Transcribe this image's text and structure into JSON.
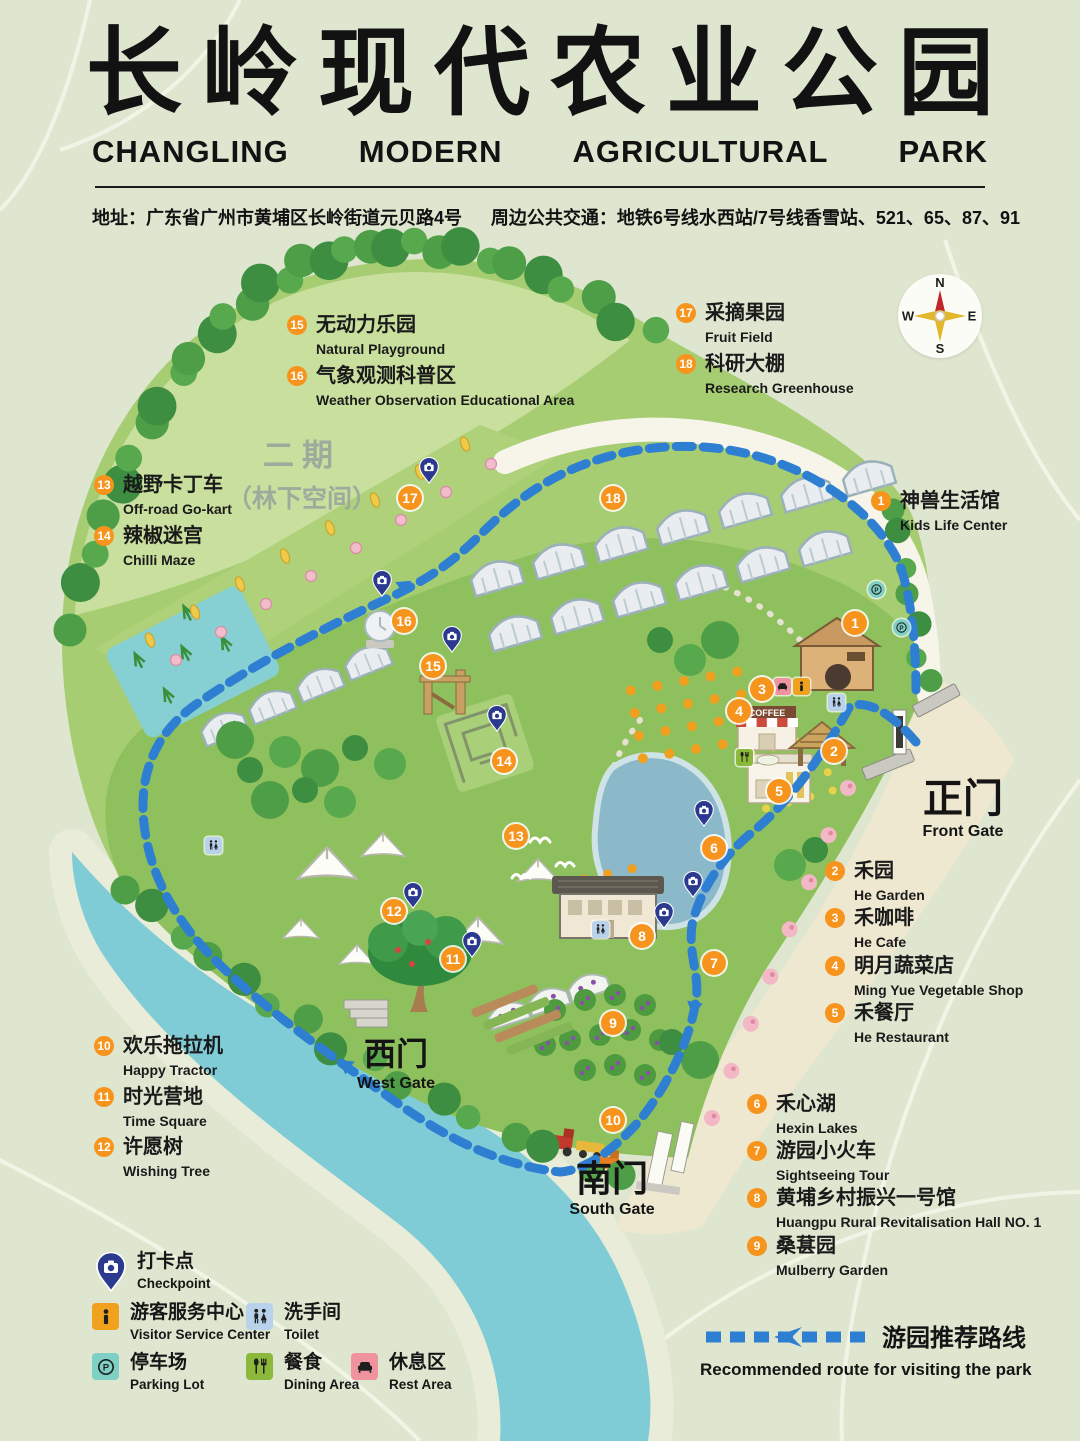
{
  "header": {
    "title_zh": "长岭现代农业公园",
    "title_en_words": [
      "CHANGLING",
      "MODERN",
      "AGRICULTURAL",
      "PARK"
    ],
    "address": "地址：广东省广州市黄埔区长岭街道元贝路4号",
    "transit": "周边公共交通：地铁6号线水西站/7号线香雪站、521、65、87、91"
  },
  "compass": {
    "n": "N",
    "e": "E",
    "s": "S",
    "w": "W"
  },
  "phase2": {
    "line1": "二期",
    "line2": "（林下空间）"
  },
  "gates": [
    {
      "id": "front-gate",
      "zh": "正门",
      "en": "Front Gate",
      "x": 963,
      "y": 778,
      "zh_size": 40
    },
    {
      "id": "west-gate",
      "zh": "西门",
      "en": "West Gate",
      "x": 396,
      "y": 1038,
      "zh_size": 32
    },
    {
      "id": "south-gate",
      "zh": "南门",
      "en": "South Gate",
      "x": 612,
      "y": 1160,
      "zh_size": 36
    }
  ],
  "pois": [
    {
      "num": 1,
      "zh": "神兽生活馆",
      "en": "Kids Life Center",
      "label": {
        "x": 881,
        "y": 501
      },
      "marker": {
        "x": 855,
        "y": 623
      }
    },
    {
      "num": 2,
      "zh": "禾园",
      "en": "He Garden",
      "label": {
        "x": 835,
        "y": 871
      },
      "marker": {
        "x": 834,
        "y": 751
      }
    },
    {
      "num": 3,
      "zh": "禾咖啡",
      "en": "He Cafe",
      "label": {
        "x": 835,
        "y": 918
      },
      "marker": {
        "x": 762,
        "y": 689
      }
    },
    {
      "num": 4,
      "zh": "明月蔬菜店",
      "en": "Ming Yue Vegetable Shop",
      "label": {
        "x": 835,
        "y": 966
      },
      "marker": {
        "x": 739,
        "y": 711
      }
    },
    {
      "num": 5,
      "zh": "禾餐厅",
      "en": "He Restaurant",
      "label": {
        "x": 835,
        "y": 1013
      },
      "marker": {
        "x": 779,
        "y": 791
      }
    },
    {
      "num": 6,
      "zh": "禾心湖",
      "en": "Hexin Lakes",
      "label": {
        "x": 757,
        "y": 1104
      },
      "marker": {
        "x": 714,
        "y": 848
      }
    },
    {
      "num": 7,
      "zh": "游园小火车",
      "en": "Sightseeing Tour",
      "label": {
        "x": 757,
        "y": 1151
      },
      "marker": {
        "x": 714,
        "y": 963
      }
    },
    {
      "num": 8,
      "zh": "黄埔乡村振兴一号馆",
      "en": "Huangpu Rural Revitalisation Hall NO. 1",
      "label": {
        "x": 757,
        "y": 1198
      },
      "marker": {
        "x": 642,
        "y": 936
      }
    },
    {
      "num": 9,
      "zh": "桑葚园",
      "en": "Mulberry Garden",
      "label": {
        "x": 757,
        "y": 1246
      },
      "marker": {
        "x": 613,
        "y": 1023
      }
    },
    {
      "num": 10,
      "zh": "欢乐拖拉机",
      "en": "Happy Tractor",
      "label": {
        "x": 104,
        "y": 1046
      },
      "marker": {
        "x": 613,
        "y": 1120
      }
    },
    {
      "num": 11,
      "zh": "时光营地",
      "en": "Time Square",
      "label": {
        "x": 104,
        "y": 1097
      },
      "marker": {
        "x": 453,
        "y": 959
      }
    },
    {
      "num": 12,
      "zh": "许愿树",
      "en": "Wishing Tree",
      "label": {
        "x": 104,
        "y": 1147
      },
      "marker": {
        "x": 394,
        "y": 911
      }
    },
    {
      "num": 13,
      "zh": "越野卡丁车",
      "en": "Off-road Go-kart",
      "label": {
        "x": 104,
        "y": 485
      },
      "marker": {
        "x": 516,
        "y": 836
      }
    },
    {
      "num": 14,
      "zh": "辣椒迷宫",
      "en": "Chilli Maze",
      "label": {
        "x": 104,
        "y": 536
      },
      "marker": {
        "x": 504,
        "y": 761
      }
    },
    {
      "num": 15,
      "zh": "无动力乐园",
      "en": "Natural Playground",
      "label": {
        "x": 297,
        "y": 325
      },
      "marker": {
        "x": 433,
        "y": 666
      }
    },
    {
      "num": 16,
      "zh": "气象观测科普区",
      "en": "Weather Observation Educational Area",
      "label": {
        "x": 297,
        "y": 376
      },
      "marker": {
        "x": 404,
        "y": 621
      }
    },
    {
      "num": 17,
      "zh": "采摘果园",
      "en": "Fruit Field",
      "label": {
        "x": 686,
        "y": 313
      },
      "marker": {
        "x": 410,
        "y": 498
      }
    },
    {
      "num": 18,
      "zh": "科研大棚",
      "en": "Research Greenhouse",
      "label": {
        "x": 686,
        "y": 364
      },
      "marker": {
        "x": 613,
        "y": 498
      }
    }
  ],
  "map": {
    "coffee_sign": "COFFEE",
    "checkpoints": [
      {
        "x": 429,
        "y": 483
      },
      {
        "x": 382,
        "y": 596
      },
      {
        "x": 452,
        "y": 652
      },
      {
        "x": 497,
        "y": 731
      },
      {
        "x": 413,
        "y": 908
      },
      {
        "x": 472,
        "y": 957
      },
      {
        "x": 704,
        "y": 826
      },
      {
        "x": 664,
        "y": 928
      },
      {
        "x": 693,
        "y": 897
      }
    ],
    "facilities": [
      {
        "type": "toilet",
        "x": 213,
        "y": 845
      },
      {
        "type": "toilet",
        "x": 836,
        "y": 702
      },
      {
        "type": "toilet",
        "x": 600,
        "y": 929
      },
      {
        "type": "parking",
        "x": 876,
        "y": 589
      },
      {
        "type": "parking",
        "x": 901,
        "y": 627
      },
      {
        "type": "dining",
        "x": 744,
        "y": 757
      },
      {
        "type": "info",
        "x": 801,
        "y": 686
      },
      {
        "type": "rest",
        "x": 782,
        "y": 686
      }
    ]
  },
  "legend": {
    "checkpoint": {
      "zh": "打卡点",
      "en": "Checkpoint",
      "x": 96,
      "y": 1252
    },
    "items": [
      {
        "id": "visitor-service-center",
        "zh": "游客服务中心",
        "en": "Visitor Service Center",
        "color": "#f0a11e",
        "icon": "info",
        "x": 92,
        "y": 1303
      },
      {
        "id": "toilet",
        "zh": "洗手间",
        "en": "Toilet",
        "color": "#b9d2ec",
        "icon": "toilet",
        "x": 246,
        "y": 1303
      },
      {
        "id": "parking-lot",
        "zh": "停车场",
        "en": "Parking Lot",
        "color": "#7fd0c4",
        "icon": "parking",
        "x": 92,
        "y": 1353
      },
      {
        "id": "dining-area",
        "zh": "餐食",
        "en": "Dining Area",
        "color": "#8cb93b",
        "icon": "dining",
        "x": 246,
        "y": 1353
      },
      {
        "id": "rest-area",
        "zh": "休息区",
        "en": "Rest Area",
        "color": "#ef949e",
        "icon": "rest",
        "x": 351,
        "y": 1353
      }
    ]
  },
  "route_legend": {
    "zh": "游园推荐路线",
    "en": "Recommended route for visiting the park"
  },
  "colors": {
    "accent": "#f7941d",
    "route": "#2e7fd2",
    "checkpoint_pin": "#2b3a8f",
    "title": "#141414",
    "background": "#dfe6d0"
  }
}
